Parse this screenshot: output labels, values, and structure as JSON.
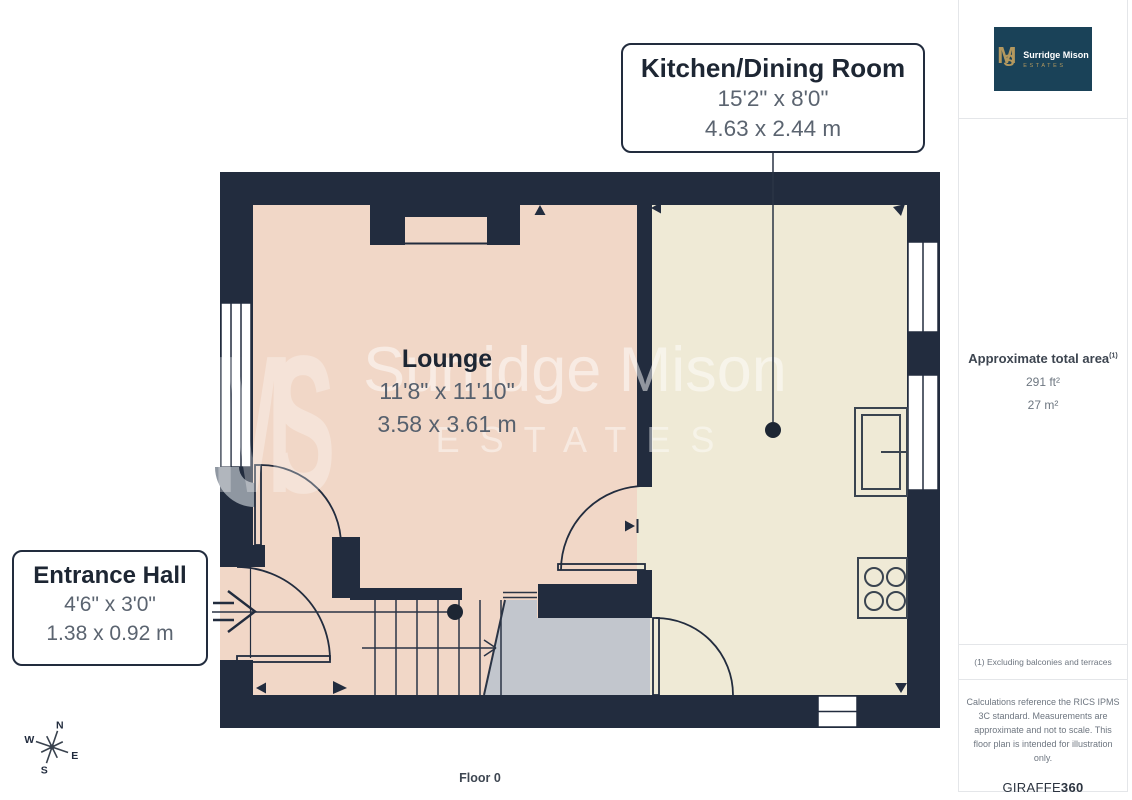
{
  "page": {
    "floor_label": "Floor 0"
  },
  "logo": {
    "monogram_m": "M",
    "monogram_s": "S",
    "name": "Surridge Mison",
    "subtitle": "ESTATES"
  },
  "sidebar": {
    "area_label": "Approximate total area",
    "area_marker": "(1)",
    "area_imperial": "291 ft²",
    "area_metric": "27 m²",
    "footnote": "(1) Excluding balconies and terraces",
    "disclaimer": "Calculations reference the RICS IPMS 3C standard. Measurements are approximate and not to scale. This floor plan is intended for illustration only.",
    "brand_name": "GIRAFFE",
    "brand_suffix": "360"
  },
  "plan": {
    "rooms": {
      "kitchen": {
        "name": "Kitchen/Dining Room",
        "imperial": "15'2\" x 8'0\"",
        "metric": "4.63 x 2.44 m"
      },
      "lounge": {
        "name": "Lounge",
        "imperial": "11'8\" x 11'10\"",
        "metric": "3.58 x 3.61 m"
      },
      "hall": {
        "name": "Entrance Hall",
        "imperial": "4'6\" x 3'0\"",
        "metric": "1.38 x 0.92 m"
      }
    },
    "compass": {
      "n": "N",
      "e": "E",
      "s": "S",
      "w": "W"
    },
    "watermark": {
      "monogram": "MS",
      "name": "Surridge Mison",
      "estates": "ESTATES"
    }
  },
  "colors": {
    "wall": "#222c3e",
    "lounge_floor": "#f1d7c7",
    "kitchen_floor": "#efead6",
    "stair_shading": "#c2c6cd",
    "logo_background": "#1a4258",
    "brand_gold": "#b3985e",
    "text_dark": "#1d2633",
    "text_muted": "#5b6470"
  }
}
